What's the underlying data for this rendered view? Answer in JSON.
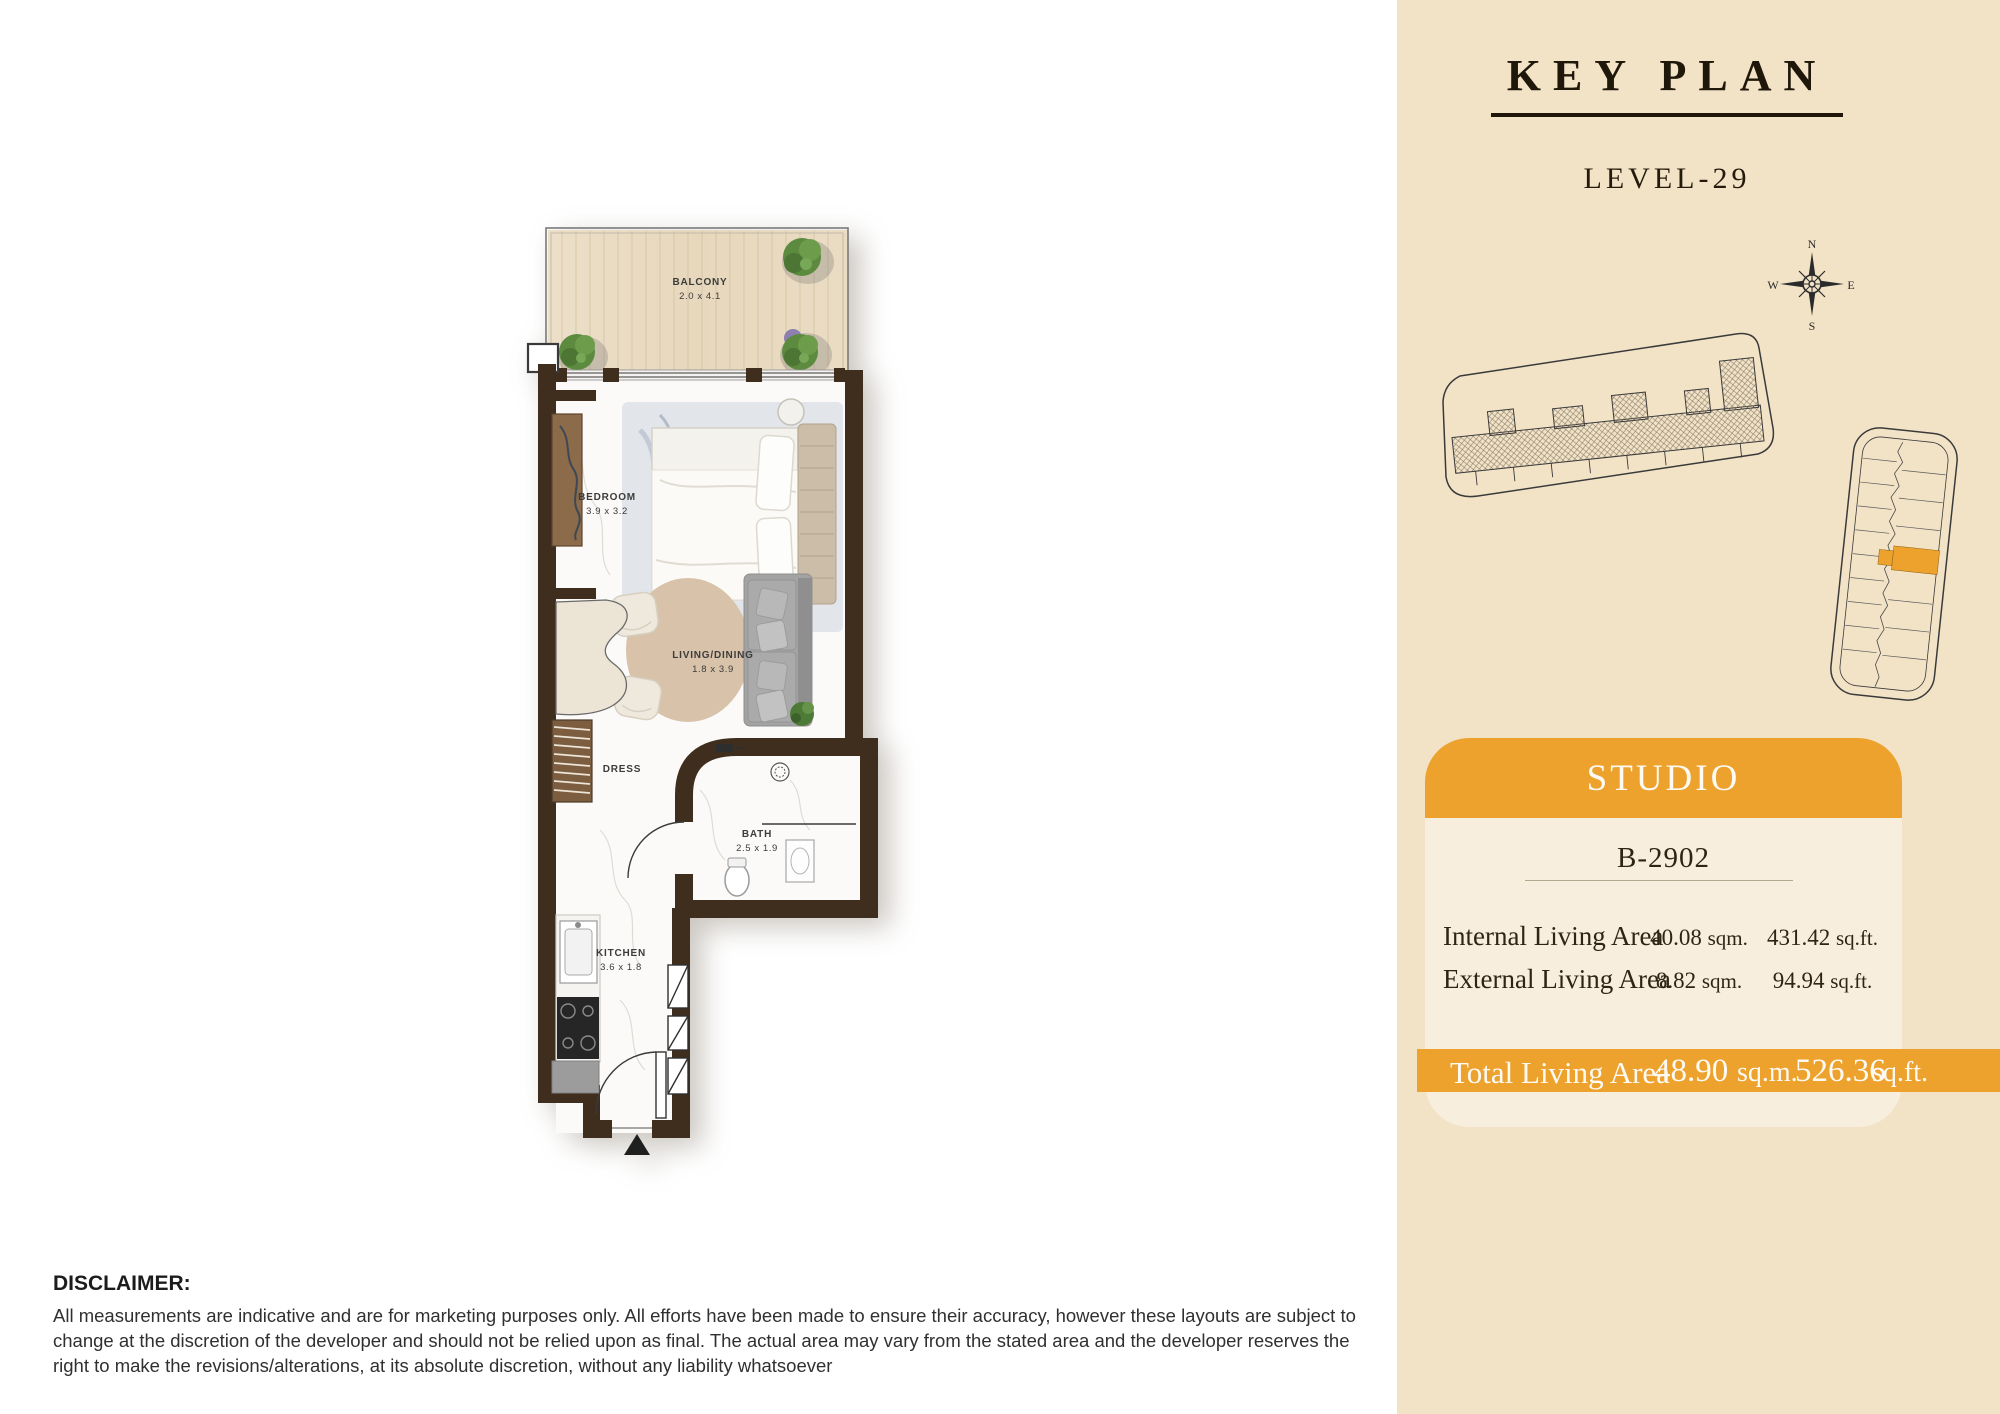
{
  "colors": {
    "panel_bg": "#f2e3c7",
    "accent_orange": "#eda22d",
    "card_bg": "#f7eedd",
    "wall_brown": "#3f2d1e",
    "balcony_wood": "#e9dbc2",
    "text_dark": "#2b2114"
  },
  "key_plan": {
    "title": "KEY PLAN",
    "level": "LEVEL-29",
    "compass": {
      "north": "N",
      "east": "E",
      "south": "S",
      "west": "W"
    }
  },
  "unit_card": {
    "type": "STUDIO",
    "unit_number": "B-2902",
    "rows": [
      {
        "label": "Internal Living Area",
        "sqm_value": "40.08",
        "sqm_unit": "sqm.",
        "sqft_value": "431.42",
        "sqft_unit": "sq.ft."
      },
      {
        "label": "External Living Area",
        "sqm_value": "8.82",
        "sqm_unit": "sqm.",
        "sqft_value": "94.94",
        "sqft_unit": "sq.ft."
      }
    ],
    "total": {
      "label": "Total Living Area",
      "sqm_value": "48.90",
      "sqm_unit": "sq.m.",
      "sqft_value": "526.36",
      "sqft_unit": "sq.ft."
    }
  },
  "floor_plan": {
    "rooms": {
      "balcony": {
        "name": "BALCONY",
        "dims": "2.0 x 4.1"
      },
      "bedroom": {
        "name": "BEDROOM",
        "dims": "3.9 x 3.2"
      },
      "living": {
        "name": "LIVING/DINING",
        "dims": "1.8 x 3.9"
      },
      "dress": {
        "name": "DRESS"
      },
      "bath": {
        "name": "BATH",
        "dims": "2.5 x 1.9"
      },
      "kitchen": {
        "name": "KITCHEN",
        "dims": "3.6 x 1.8"
      }
    }
  },
  "disclaimer": {
    "heading": "DISCLAIMER:",
    "body": "All measurements are indicative and are for marketing purposes only. All efforts have been made to ensure their accuracy, however these layouts are subject to change at the discretion of the developer and should not be relied upon as final. The actual area may vary from the stated area and the developer reserves the right to make the revisions/alterations, at its absolute discretion, without any liability whatsoever"
  }
}
